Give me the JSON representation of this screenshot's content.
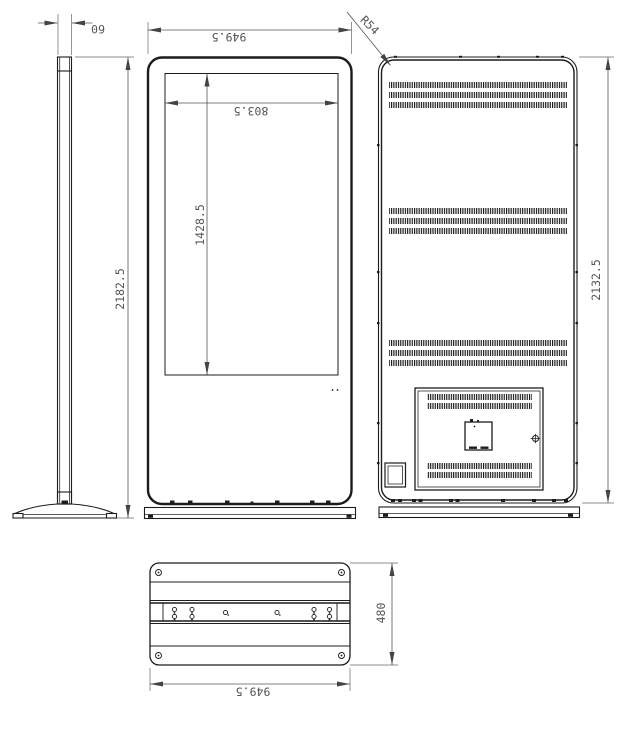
{
  "colors": {
    "line": "#1c1c1c",
    "dim_text": "#555555",
    "background": "#ffffff"
  },
  "dimensions": {
    "side_thickness": "60",
    "side_overall_height": "2182.5",
    "front_overall_width": "949.5",
    "screen_width": "803.5",
    "screen_height": "1428.5",
    "back_corner_radius": "R54",
    "back_height": "2132.5",
    "base_depth": "480",
    "base_width": "949.5"
  }
}
